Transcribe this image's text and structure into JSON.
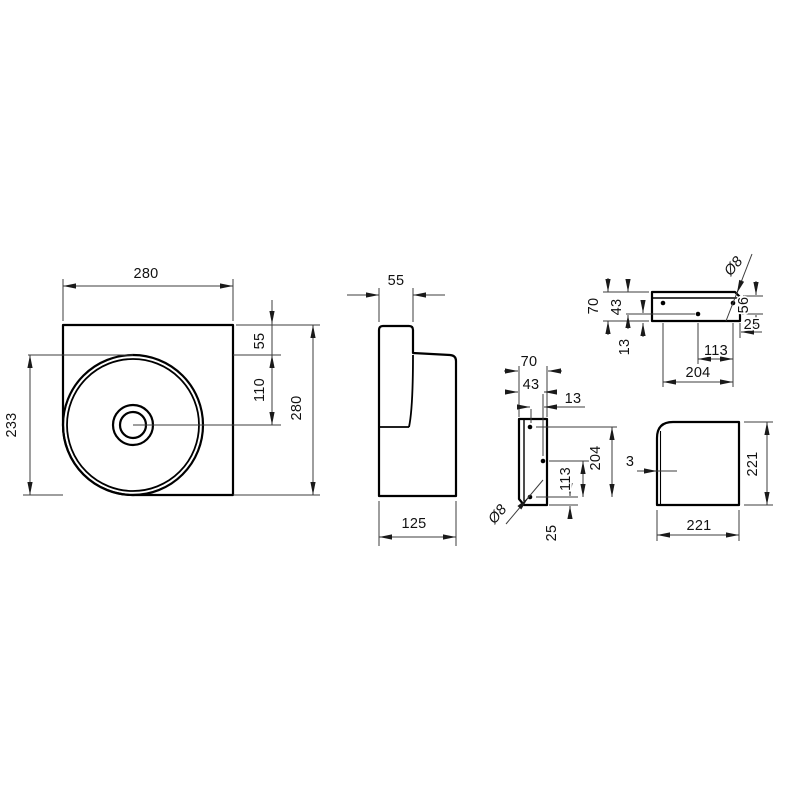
{
  "drawing": {
    "type": "technical dimension drawing",
    "background": "#ffffff",
    "line_color": "#000000",
    "dim_line_color": "#3c3c3c",
    "text_color": "#111111",
    "views": {
      "basin_front": {
        "title": "washbasin front view",
        "dims": {
          "width_top": "280",
          "height_right": "280",
          "left_height": "233",
          "rim_offset": "55",
          "drain_offset": "110"
        }
      },
      "basin_side": {
        "title": "washbasin side view",
        "dims": {
          "top_depth": "55",
          "base_depth": "125"
        }
      },
      "bracket_front": {
        "title": "mounting bracket horizontal view",
        "dims": {
          "height": "70",
          "hole_row_offset": "43",
          "hole_row_gap": "13",
          "right_offset": "56",
          "hole_edge": "25",
          "hole_pitch_half": "113",
          "hole_pitch": "204",
          "hole_dia": "Ø8"
        }
      },
      "bracket_side": {
        "title": "mounting bracket vertical view",
        "dims": {
          "width": "70",
          "hole_col_offset": "43",
          "hole_col_gap": "13",
          "hole_pitch": "204",
          "hole_pitch_half": "113",
          "hole_edge": "25",
          "hole_dia": "Ø8"
        }
      },
      "cover": {
        "title": "corner cover view",
        "dims": {
          "thickness": "3",
          "height_right": "221",
          "width_bottom": "221"
        }
      }
    }
  }
}
